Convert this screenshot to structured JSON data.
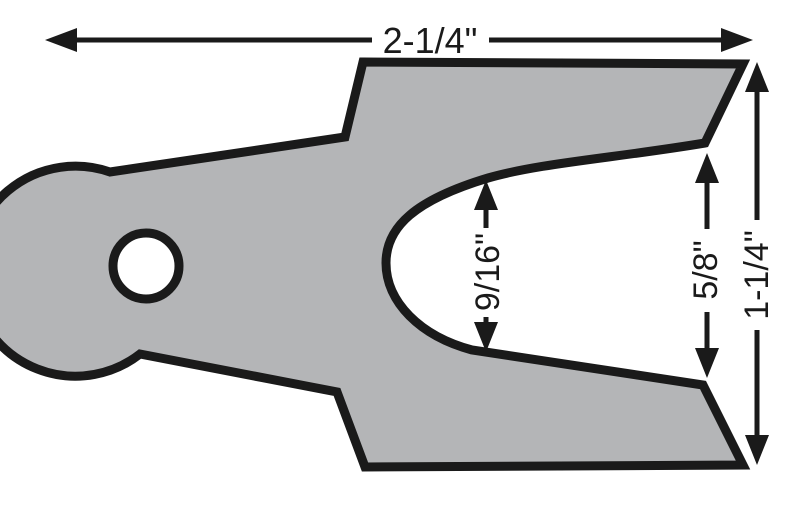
{
  "diagram": {
    "type": "technical-dimension-drawing",
    "part": "slotted-shim-with-mounting-hole"
  },
  "colors": {
    "shim_fill": "#b4b5b7",
    "outline": "#1a1a1a",
    "background": "#ffffff",
    "hole_fill": "#ffffff"
  },
  "dimensions": {
    "overall_width": {
      "label": "2-1/4\""
    },
    "slot_width": {
      "label": "9/16\""
    },
    "slot_opening_height": {
      "label": "5/8\""
    },
    "overall_height": {
      "label": "1-1/4\""
    }
  }
}
